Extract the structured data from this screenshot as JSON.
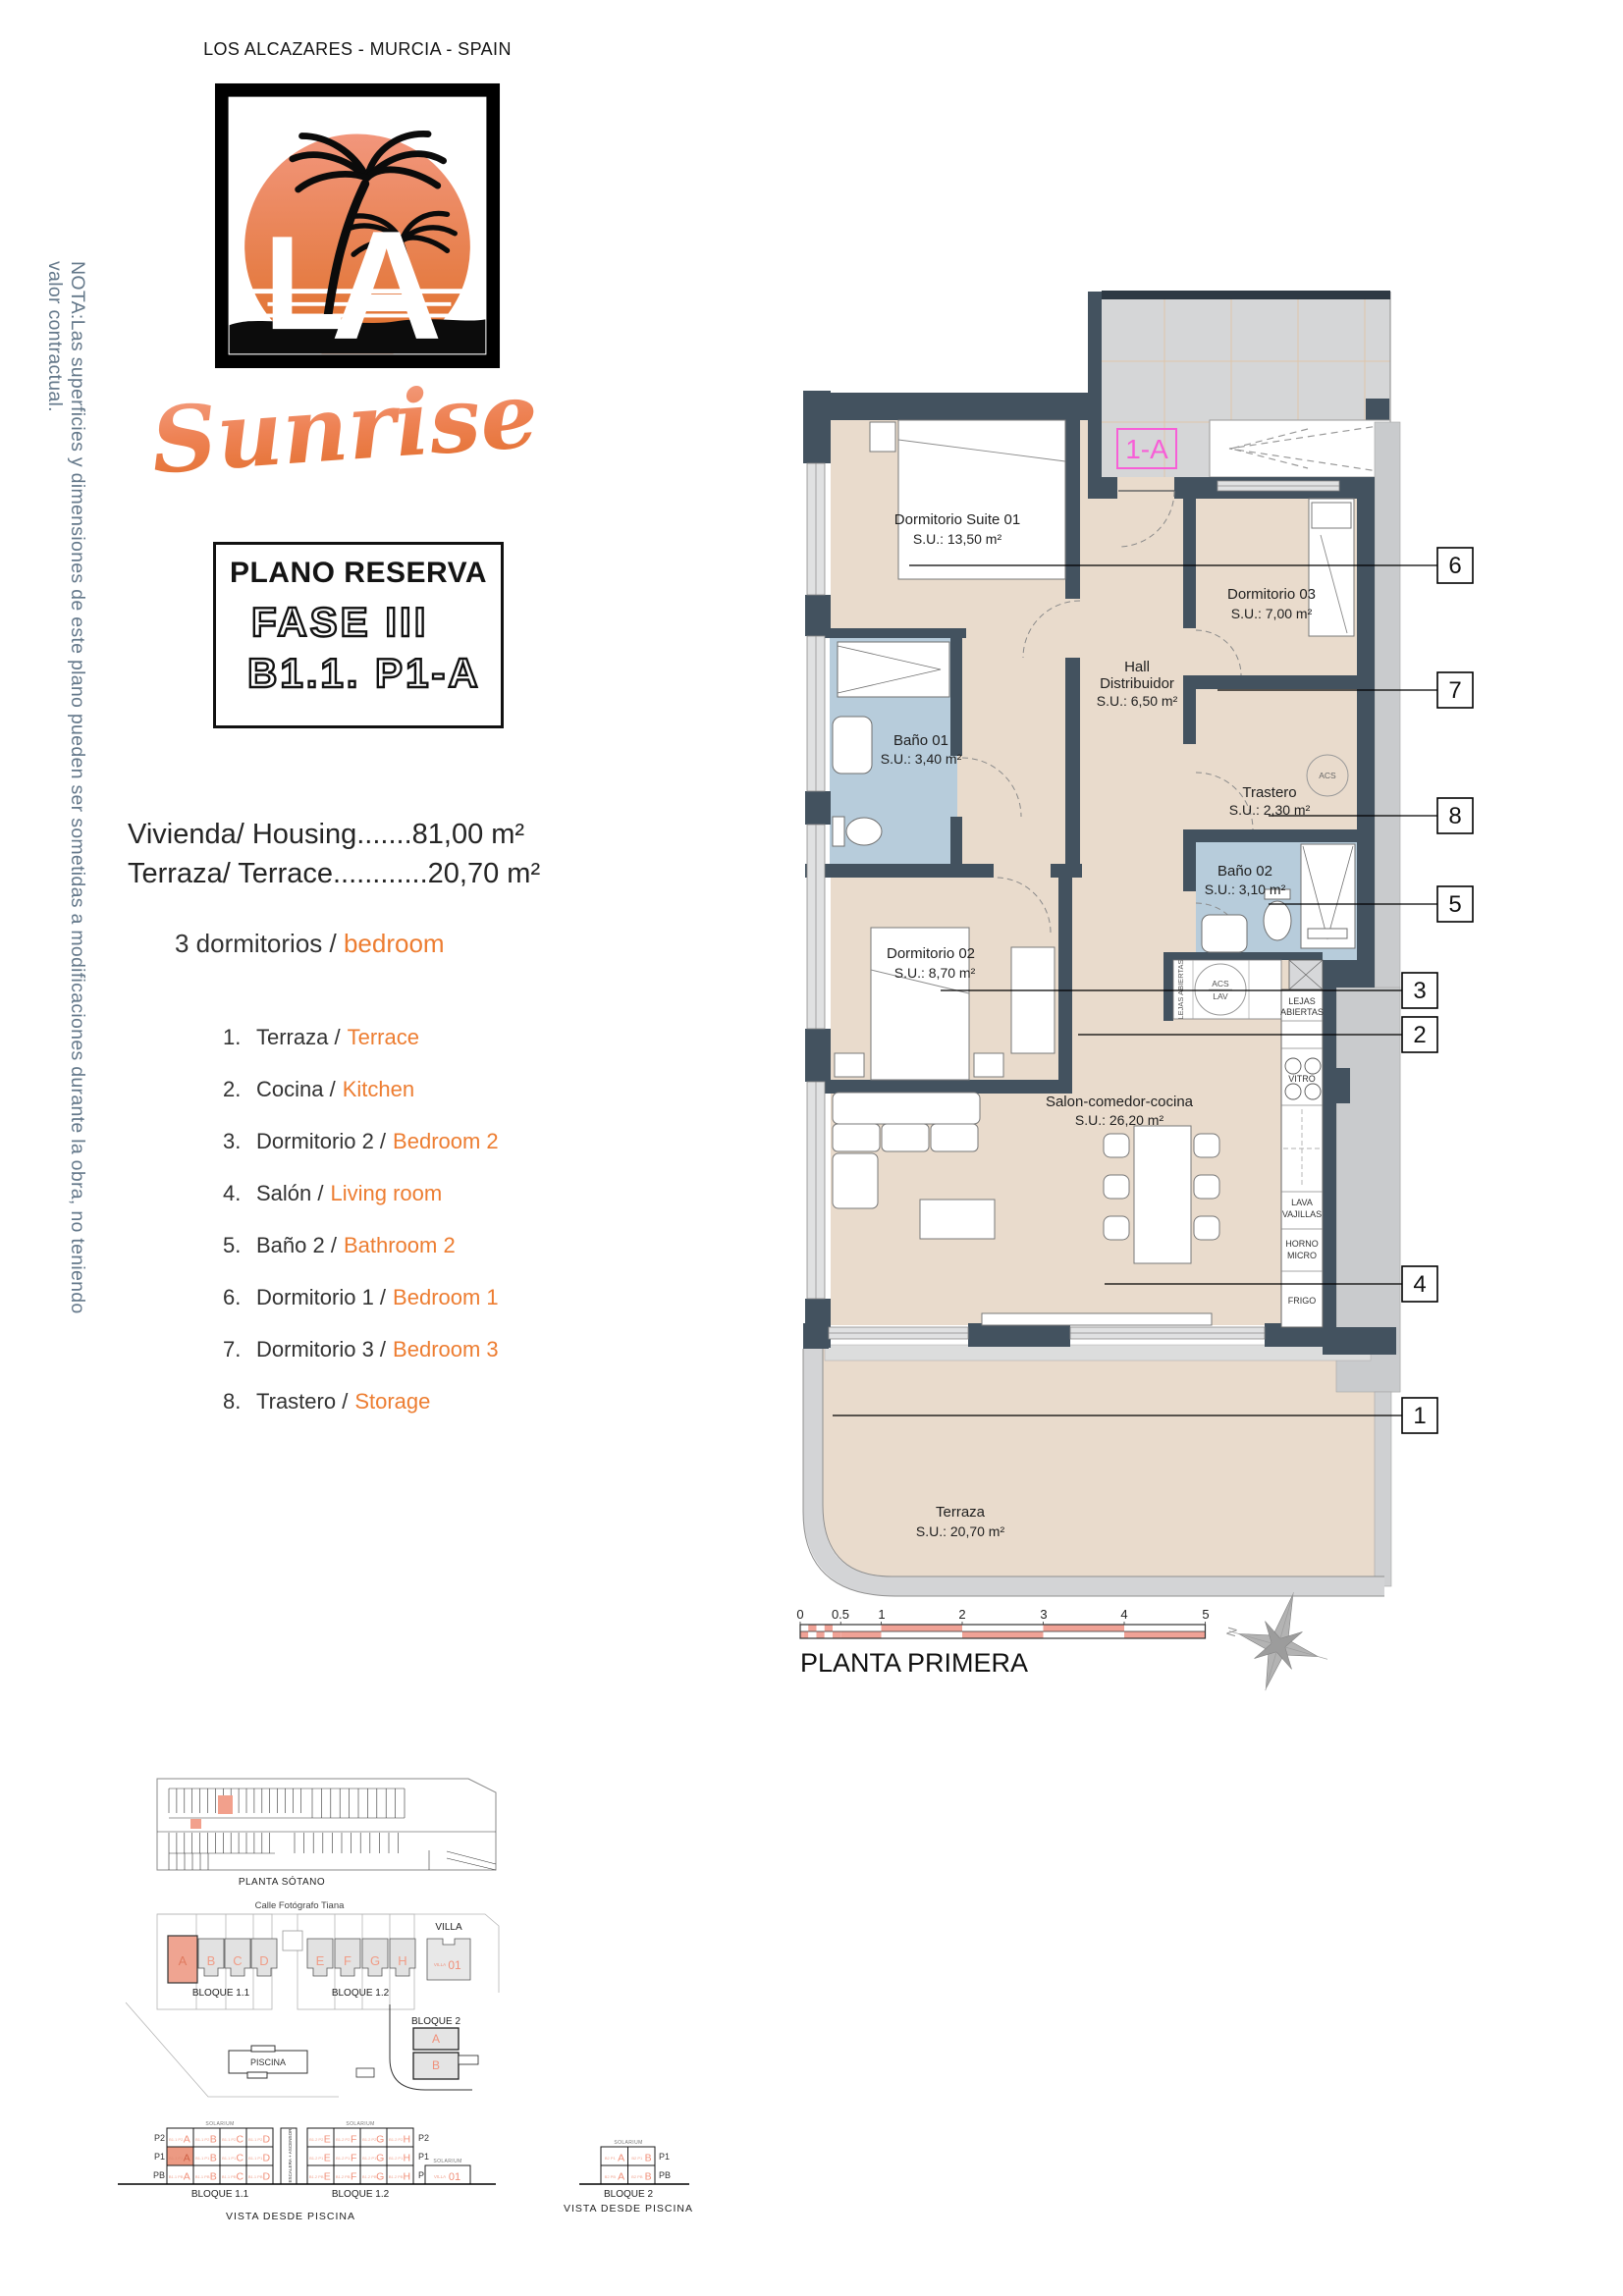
{
  "header": {
    "location": "LOS ALCAZARES - MURCIA - SPAIN",
    "brand_script": "Sunrise",
    "logo_letter_l": "L",
    "logo_letter_a": "A"
  },
  "note_vertical": "NOTA:Las superficies y dimensiones de este plano pueden ser sometidas a modificaciones durante la obra, no teniendo valor contractual.",
  "reserve": {
    "title": "PLANO RESERVA",
    "phase": "FASE III",
    "unit": "B1.1. P1-A"
  },
  "summary": {
    "line1": "Vivienda/ Housing.......81,00 m²",
    "line2": "Terraza/ Terrace............20,70 m²",
    "bedrooms_es": "3 dormitorios / ",
    "bedrooms_en": "bedroom"
  },
  "legend": [
    {
      "n": "1.",
      "es": "Terraza /",
      "en": "Terrace"
    },
    {
      "n": "2.",
      "es": "Cocina /",
      "en": "Kitchen"
    },
    {
      "n": "3.",
      "es": "Dormitorio 2 /",
      "en": "Bedroom 2"
    },
    {
      "n": "4.",
      "es": "Salón /",
      "en": "Living room"
    },
    {
      "n": "5.",
      "es": "Baño 2 /",
      "en": "Bathroom 2"
    },
    {
      "n": "6.",
      "es": "Dormitorio 1 /",
      "en": "Bedroom 1"
    },
    {
      "n": "7.",
      "es": "Dormitorio 3 /",
      "en": "Bedroom 3"
    },
    {
      "n": "8.",
      "es": "Trastero /",
      "en": "Storage"
    }
  ],
  "plan": {
    "unit_tag": "1-A",
    "floor_title": "PLANTA PRIMERA",
    "compass_n": "N",
    "rooms": {
      "suite": {
        "name": "Dormitorio Suite 01",
        "area": "S.U.: 13,50 m²"
      },
      "bano1": {
        "name": "Baño 01",
        "area": "S.U.: 3,40 m²"
      },
      "dorm3": {
        "name": "Dormitorio 03",
        "area": "S.U.: 7,00 m²"
      },
      "hall": {
        "l1": "Hall",
        "l2": "Distribuidor",
        "area": "S.U.: 6,50 m²"
      },
      "trastero": {
        "name": "Trastero",
        "area": "S.U.: 2,30 m²"
      },
      "bano2": {
        "name": "Baño 02",
        "area": "S.U.: 3,10 m²"
      },
      "dorm2": {
        "name": "Dormitorio 02",
        "area": "S.U.: 8,70 m²"
      },
      "salon": {
        "name": "Salon-comedor-cocina",
        "area": "S.U.: 26,20 m²"
      },
      "terraza": {
        "name": "Terraza",
        "area": "S.U.: 20,70 m²"
      }
    },
    "kitchen": {
      "lejas": "LEJAS ABIERTAS",
      "lejas1": "LEJAS",
      "lejas2": "ABIERTAS",
      "acs": "ACS",
      "lav": "LAV",
      "vitro": "VITRO",
      "lava1": "LAVA",
      "lava2": "VAJILLAS",
      "horno1": "HORNO",
      "horno2": "MICRO",
      "frigo": "FRIGO"
    },
    "callouts": [
      "6",
      "7",
      "8",
      "5",
      "3",
      "2",
      "4",
      "1"
    ],
    "scale_ticks": [
      "0",
      "0.5",
      "1",
      "2",
      "3",
      "4",
      "5"
    ]
  },
  "site": {
    "sotano_label": "PLANTA SÓTANO",
    "street": "Calle Fotógrafo Tiana",
    "b11": "BLOQUE 1.1",
    "b12": "BLOQUE 1.2",
    "b2": "BLOQUE 2",
    "villa": "VILLA",
    "villa_pre": "VILLA",
    "villa_num": "01",
    "piscina": "PISCINA",
    "letters11": [
      "A",
      "B",
      "C",
      "D"
    ],
    "letters12": [
      "E",
      "F",
      "G",
      "H"
    ],
    "letters2": [
      "A",
      "B"
    ]
  },
  "vista": {
    "caption": "VISTA DESDE PISCINA",
    "solarium": "SOLARIUM",
    "stair_core": "ESCALERA + ASCENSOR",
    "rows": [
      "P2",
      "P1",
      "PB"
    ],
    "rows2": [
      "P1",
      "PB"
    ],
    "b11_prefix": "B1.1",
    "b12_prefix": "B1.2",
    "b2_prefix": "B2",
    "highlight": {
      "row": "P1",
      "letter": "A"
    }
  },
  "colors": {
    "orange": "#ED7D31",
    "wall": "#43525f",
    "floor_tan": "#e9dbcc",
    "bath_blue": "#b7ccdb",
    "salmon": "#f2a28f",
    "magenta": "#f75fd7",
    "note_blue": "#64788a",
    "landing_gray": "#d5d6d7"
  }
}
